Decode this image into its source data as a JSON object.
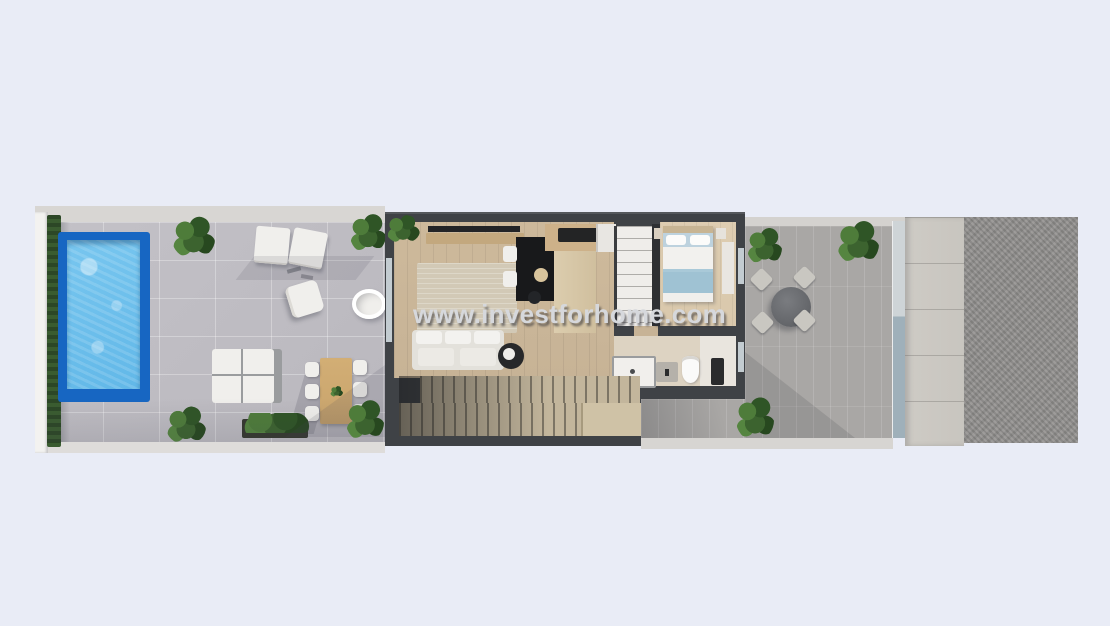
{
  "watermark": {
    "text": "www.investforhome.com"
  },
  "scene": {
    "colors": {
      "background": "#e9ecf6",
      "boundary_wall": "#f3f2f0",
      "perimeter_band": "#d8d6d3",
      "hedge": "#34512b",
      "terrace_tile": "#bab8be",
      "pool_border": "#1766c2",
      "pool_water": "#62b8e8",
      "building_wall": "#3f4246",
      "wood_floor": "#c7b396",
      "bedroom_floor": "#d9c8ac",
      "rug": "#d2c9b6",
      "kitchen_wood": "#cdb189",
      "island_dark": "#18191b",
      "white_furniture": "#f0efec",
      "bed_blanket": "#9fc2d3",
      "bed_pillow_band": "#bdd2de",
      "stair_tread": "#c3b69c",
      "rear_terrace": "#a9a7a5",
      "stone_walkway": "#c8c5bf",
      "gravel": "#918f8d",
      "glass": "#c3ccd1",
      "plant_green": "#3c632f",
      "outdoor_table_wood": "#c9a46c",
      "watermark_text": "#d6d8dc"
    }
  }
}
